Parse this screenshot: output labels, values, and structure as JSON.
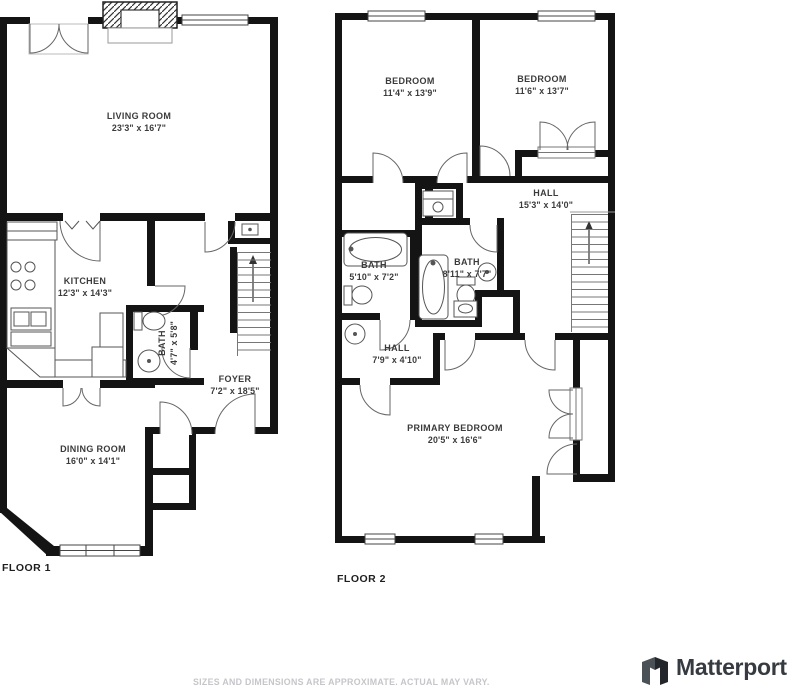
{
  "colors": {
    "wall": "#141414",
    "fixture_line": "#555555",
    "door_line": "#666666",
    "label_text": "#3b3b3b",
    "floor_label_text": "#1e1e1e",
    "disclaimer_text": "#c6c6ca",
    "brand_text": "#363b41"
  },
  "floor1": {
    "label": "FLOOR 1",
    "rooms": [
      {
        "name": "LIVING ROOM",
        "dims": "23'3\" x 16'7\""
      },
      {
        "name": "KITCHEN",
        "dims": "12'3\" x 14'3\""
      },
      {
        "name": "BATH",
        "dims": "4'7\" x 5'8\""
      },
      {
        "name": "FOYER",
        "dims": "7'2\" x 18'5\""
      },
      {
        "name": "DINING ROOM",
        "dims": "16'0\" x 14'1\""
      }
    ]
  },
  "floor2": {
    "label": "FLOOR 2",
    "rooms": [
      {
        "name": "BEDROOM",
        "dims": "11'4\" x 13'9\""
      },
      {
        "name": "BEDROOM",
        "dims": "11'6\" x 13'7\""
      },
      {
        "name": "HALL",
        "dims": "15'3\" x 14'0\""
      },
      {
        "name": "BATH",
        "dims": "5'10\" x 7'2\""
      },
      {
        "name": "BATH",
        "dims": "8'11\" x 7'7\""
      },
      {
        "name": "HALL",
        "dims": "7'9\" x 4'10\""
      },
      {
        "name": "PRIMARY BEDROOM",
        "dims": "20'5\" x 16'6\""
      }
    ]
  },
  "footer": {
    "disclaimer": "SIZES AND DIMENSIONS ARE APPROXIMATE. ACTUAL MAY VARY.",
    "brand": "Matterport"
  }
}
